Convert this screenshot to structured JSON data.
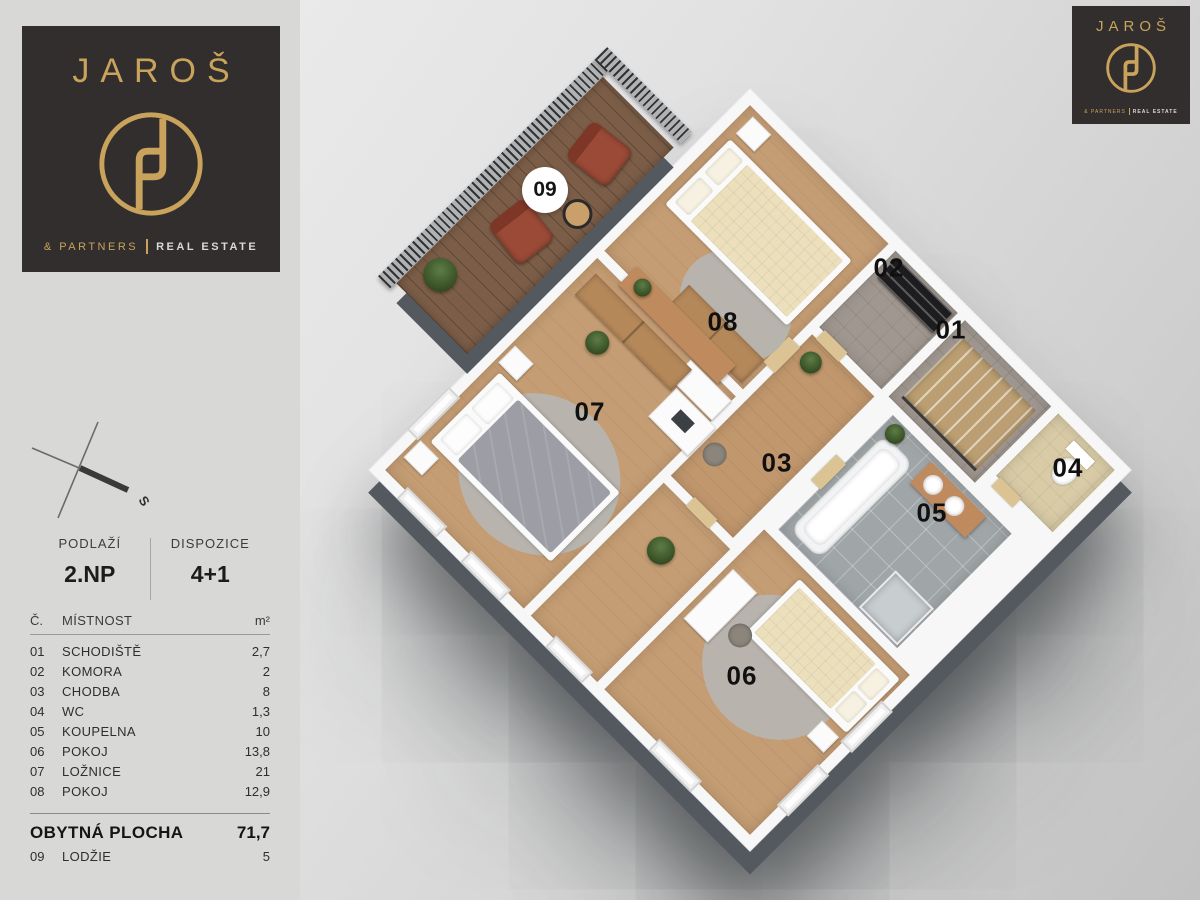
{
  "brand": {
    "name": "JAROŠ",
    "partners": "& PARTNERS",
    "divider": "|",
    "real_estate": "REAL ESTATE",
    "gold": "#c9a35c",
    "dark": "#312e2d"
  },
  "compass": {
    "south": "S"
  },
  "info": {
    "floor_label": "PODLAŽÍ",
    "floor_value": "2.NP",
    "disp_label": "DISPOZICE",
    "disp_value": "4+1"
  },
  "table": {
    "headers": {
      "num": "Č.",
      "name": "MÍSTNOST",
      "area": "m²"
    },
    "rows": [
      {
        "num": "01",
        "name": "SCHODIŠTĚ",
        "area": "2,7"
      },
      {
        "num": "02",
        "name": "KOMORA",
        "area": "2"
      },
      {
        "num": "03",
        "name": "CHODBA",
        "area": "8"
      },
      {
        "num": "04",
        "name": "WC",
        "area": "1,3"
      },
      {
        "num": "05",
        "name": "KOUPELNA",
        "area": "10"
      },
      {
        "num": "06",
        "name": "POKOJ",
        "area": "13,8"
      },
      {
        "num": "07",
        "name": "LOŽNICE",
        "area": "21"
      },
      {
        "num": "08",
        "name": "POKOJ",
        "area": "12,9"
      }
    ],
    "total": {
      "label": "OBYTNÁ PLOCHA",
      "value": "71,7"
    },
    "extra": {
      "num": "09",
      "name": "LODŽIE",
      "area": "5"
    }
  },
  "plan": {
    "labels": [
      {
        "id": "01"
      },
      {
        "id": "02"
      },
      {
        "id": "03"
      },
      {
        "id": "04"
      },
      {
        "id": "05"
      },
      {
        "id": "06"
      },
      {
        "id": "07"
      },
      {
        "id": "08"
      },
      {
        "id": "09"
      }
    ],
    "colors": {
      "wood_floor": "#c59d74",
      "balcony_wood": "#7c5e48",
      "bath_tile": "#a0a5a8",
      "carpet": "#a09890",
      "wc_floor": "#d9cba6",
      "wall": "#f7f7f7",
      "slab_shadow": "#545960"
    }
  }
}
